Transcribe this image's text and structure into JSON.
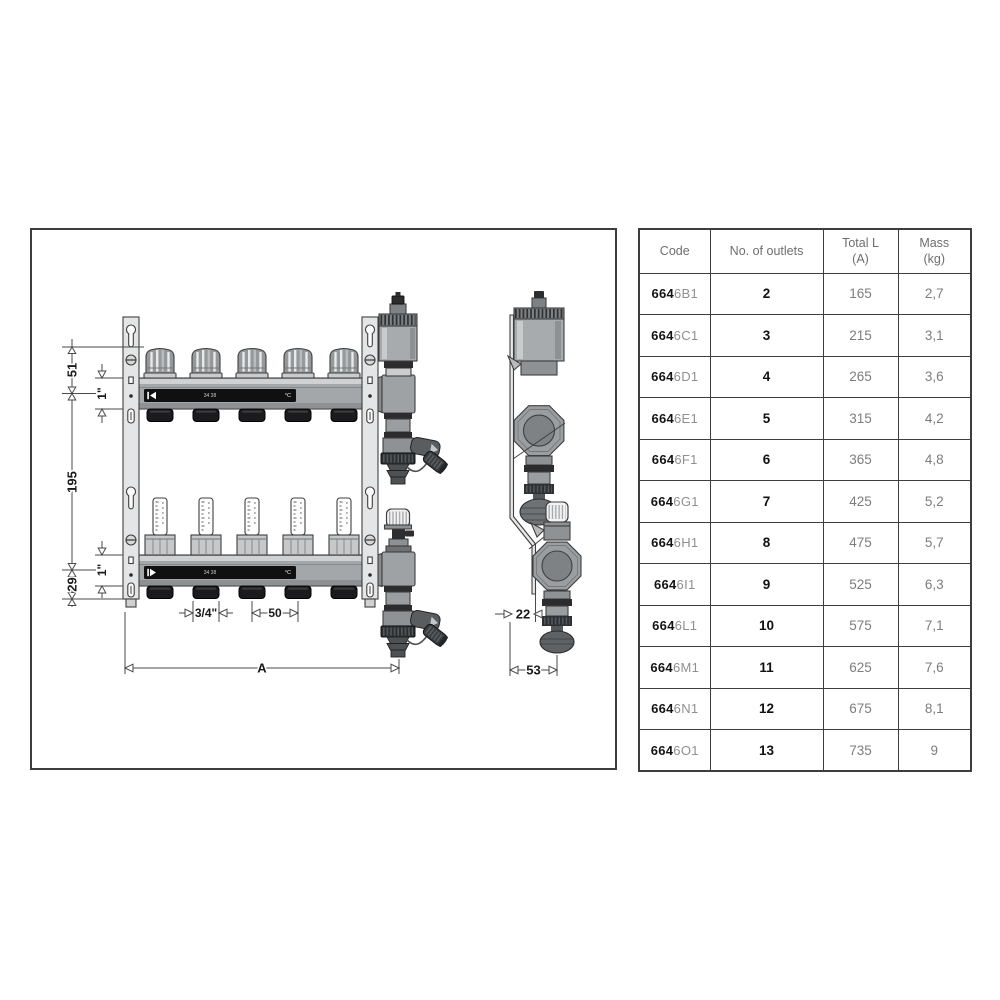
{
  "figure": {
    "dims": {
      "top_offset": "51",
      "pipe_top": "1\"",
      "axis_spacing": "195",
      "pipe_bottom": "1\"",
      "bottom_offset": "29",
      "outlet_thread": "3/4\"",
      "outlet_spacing": "50",
      "length": "A",
      "side_offset": "22",
      "side_depth": "53"
    },
    "manifold_label": {
      "scale": "34 38",
      "unit": "°C"
    }
  },
  "table": {
    "headers": [
      {
        "line1": "Code",
        "line2": ""
      },
      {
        "line1": "No. of outlets",
        "line2": ""
      },
      {
        "line1": "Total L",
        "line2": "(A)"
      },
      {
        "line1": "Mass",
        "line2": "(kg)"
      }
    ],
    "rows": [
      {
        "code_prefix": "664",
        "code_suffix": "6B1",
        "outlets": "2",
        "total_l": "165",
        "mass": "2,7"
      },
      {
        "code_prefix": "664",
        "code_suffix": "6C1",
        "outlets": "3",
        "total_l": "215",
        "mass": "3,1"
      },
      {
        "code_prefix": "664",
        "code_suffix": "6D1",
        "outlets": "4",
        "total_l": "265",
        "mass": "3,6"
      },
      {
        "code_prefix": "664",
        "code_suffix": "6E1",
        "outlets": "5",
        "total_l": "315",
        "mass": "4,2"
      },
      {
        "code_prefix": "664",
        "code_suffix": "6F1",
        "outlets": "6",
        "total_l": "365",
        "mass": "4,8"
      },
      {
        "code_prefix": "664",
        "code_suffix": "6G1",
        "outlets": "7",
        "total_l": "425",
        "mass": "5,2"
      },
      {
        "code_prefix": "664",
        "code_suffix": "6H1",
        "outlets": "8",
        "total_l": "475",
        "mass": "5,7"
      },
      {
        "code_prefix": "664",
        "code_suffix": "6I1",
        "outlets": "9",
        "total_l": "525",
        "mass": "6,3"
      },
      {
        "code_prefix": "664",
        "code_suffix": "6L1",
        "outlets": "10",
        "total_l": "575",
        "mass": "7,1"
      },
      {
        "code_prefix": "664",
        "code_suffix": "6M1",
        "outlets": "11",
        "total_l": "625",
        "mass": "7,6"
      },
      {
        "code_prefix": "664",
        "code_suffix": "6N1",
        "outlets": "12",
        "total_l": "675",
        "mass": "8,1"
      },
      {
        "code_prefix": "664",
        "code_suffix": "6O1",
        "outlets": "13",
        "total_l": "735",
        "mass": "9"
      }
    ]
  }
}
